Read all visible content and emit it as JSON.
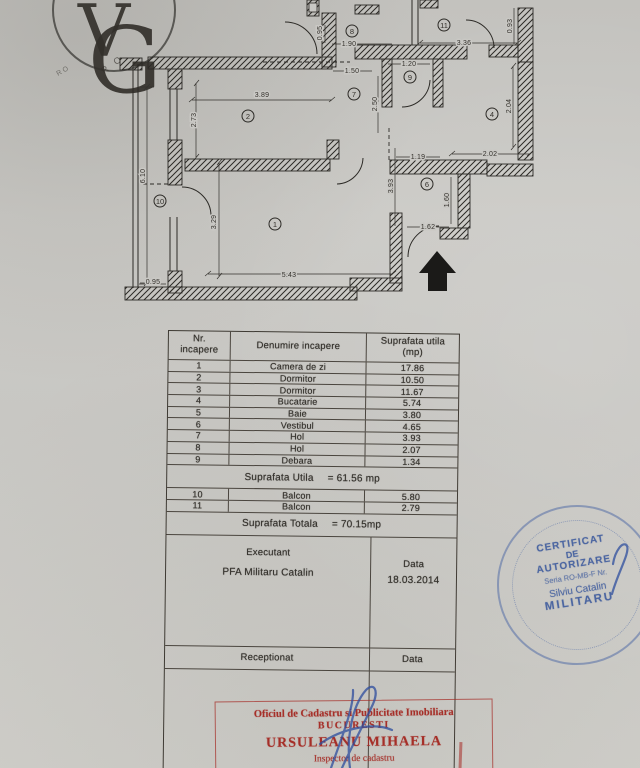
{
  "page": {
    "logo_monogram_v": "V",
    "logo_monogram_g": "G",
    "imprint_text": "R O",
    "imprint_text2": "RO"
  },
  "plan": {
    "rooms": [
      "1",
      "2",
      "4",
      "6",
      "7",
      "8",
      "9",
      "10",
      "11"
    ],
    "dimensions": [
      "3.89",
      "2.73",
      "6.10",
      "0.95",
      "3.29",
      "5.43",
      "1.90",
      "0.95",
      "1.50",
      "1.20",
      "2.50",
      "3.36",
      "0.93",
      "2.04",
      "2.02",
      "1.19",
      "3.93",
      "1.60",
      "1.62"
    ]
  },
  "table": {
    "headers": {
      "col1a": "Nr.",
      "col1b": "incapere",
      "col2": "Denumire incapere",
      "col3a": "Suprafata utila",
      "col3b": "(mp)"
    },
    "rows": [
      {
        "nr": "1",
        "name": "Camera de zi",
        "area": "17.86"
      },
      {
        "nr": "2",
        "name": "Dormitor",
        "area": "10.50"
      },
      {
        "nr": "3",
        "name": "Dormitor",
        "area": "11.67"
      },
      {
        "nr": "4",
        "name": "Bucatarie",
        "area": "5.74"
      },
      {
        "nr": "5",
        "name": "Baie",
        "area": "3.80"
      },
      {
        "nr": "6",
        "name": "Vestibul",
        "area": "4.65"
      },
      {
        "nr": "7",
        "name": "Hol",
        "area": "3.93"
      },
      {
        "nr": "8",
        "name": "Hol",
        "area": "2.07"
      },
      {
        "nr": "9",
        "name": "Debara",
        "area": "1.34"
      }
    ],
    "subtotal": {
      "label": "Suprafata Utila",
      "value": "= 61.56 mp"
    },
    "balconies": [
      {
        "nr": "10",
        "name": "Balcon",
        "area": "5.80"
      },
      {
        "nr": "11",
        "name": "Balcon",
        "area": "2.79"
      }
    ],
    "total": {
      "label": "Suprafata Totala",
      "value": "= 70.15mp"
    },
    "executant": {
      "label": "Executant",
      "name": "PFA Militaru Catalin",
      "date_label": "Data",
      "date": "18.03.2014"
    },
    "reception": {
      "label": "Receptionat",
      "date_label": "Data"
    }
  },
  "stamps": {
    "registry": {
      "line1": "Oficiul de Cadastru si Publicitate Imobiliara",
      "line2": "BUCURESTI",
      "line3": "URSULEANU MIHAELA",
      "line4": "Inspector de cadastru",
      "color": "#a42822"
    },
    "authorization": {
      "line1": "CERTIFICAT",
      "line2": "DE",
      "line3": "AUTORIZARE",
      "line4": "Seria RO-MB-F Nr.",
      "line5": "Silviu Catalin",
      "line6": "MILITARU",
      "color": "#425e9e"
    }
  }
}
